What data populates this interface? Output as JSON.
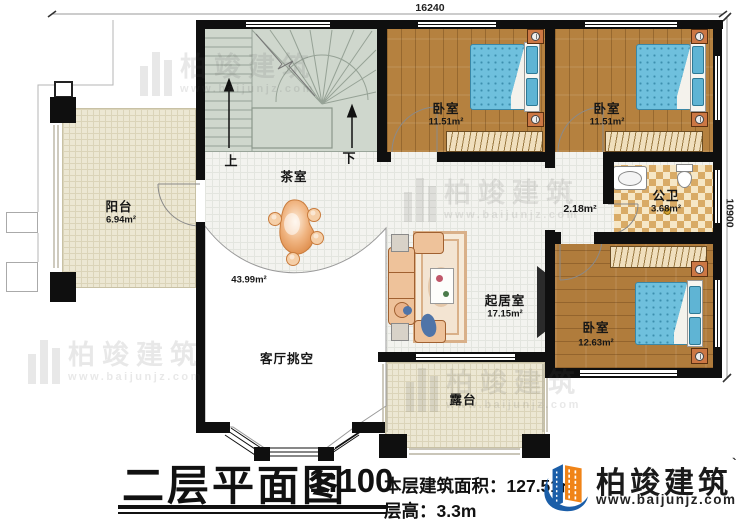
{
  "dimensions": {
    "top": "16240",
    "right": "10900"
  },
  "rooms": [
    {
      "name": "阳台",
      "area": "6.94m²"
    },
    {
      "name": "茶室"
    },
    {
      "name": "卧室",
      "area": "11.51m²"
    },
    {
      "name": "卧室",
      "area": "11.51m²"
    },
    {
      "area": "2.18m²"
    },
    {
      "name": "公卫",
      "area": "3.68m²"
    },
    {
      "name": "卧室",
      "area": "12.63m²"
    },
    {
      "name": "起居室",
      "area": "17.15m²"
    },
    {
      "name": "客厅挑空",
      "area": "43.99m²"
    },
    {
      "name": "露台"
    }
  ],
  "stairs": {
    "up": "上",
    "down": "下"
  },
  "titleblock": {
    "title": "二层平面图",
    "scale": "1:100",
    "building_area": "本层建筑面积：127.51㎡",
    "floor_height": "层高：3.3m"
  },
  "brand": {
    "name": "柏竣建筑",
    "mark": "`",
    "url": "www.baijunjz.com"
  },
  "watermark": {
    "name": "柏竣建筑",
    "url": "www.baijunjz.com"
  },
  "colors": {
    "wall": "#0f0f0f",
    "wood_floor": "#b5813f",
    "tile_floor": "#f3f3ef",
    "outdoor_floor": "#ece7d3",
    "stair_floor": "#cfd7cd",
    "bathroom_tile": "#d9ab66",
    "bed_blue": "#6fc0dd",
    "furniture_tan": "#eec29a",
    "logo_blue": "#1b5ea8",
    "logo_orange": "#f08418"
  }
}
